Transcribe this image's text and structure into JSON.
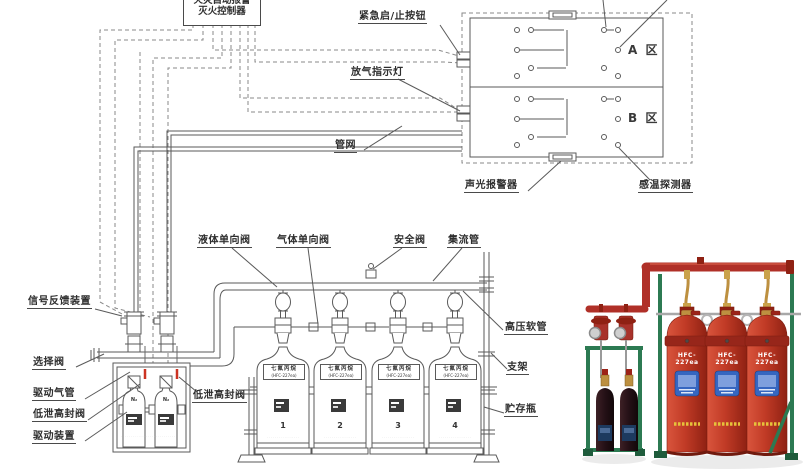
{
  "controller": {
    "line1": "火灾自动报警",
    "line2": "灭火控制器"
  },
  "zones": {
    "a": "A 区",
    "b": "B 区"
  },
  "labels": {
    "emergency_button": "紧急启/止按钮",
    "release_indicator": "放气指示灯",
    "pipe_network": "管网",
    "sound_light_alarm": "声光报警器",
    "heat_detector": "感温探测器",
    "liquid_check_valve": "液体单向阀",
    "gas_check_valve": "气体单向阀",
    "safety_valve": "安全阀",
    "manifold": "集流管",
    "signal_feedback": "信号反馈装置",
    "selector_valve": "选择阀",
    "drive_gas_pipe": "驱动气管",
    "low_leak_valve_left": "低泄高封阀",
    "drive_device": "驱动装置",
    "low_leak_valve_right": "低泄高封阀",
    "hp_hose": "高压软管",
    "bracket": "支架",
    "storage_bottle": "贮存瓶"
  },
  "cylinders": {
    "plate_line1": "七氟丙烷",
    "plate_line2": "(HFC-227ea)",
    "numbers": [
      "1",
      "2",
      "3",
      "4"
    ],
    "fine_print": "·······················"
  },
  "drive_bottles": {
    "gas_label": "N₂",
    "box_fine_print": "····························"
  },
  "photo": {
    "cylinder_text": "HFC-227ea"
  },
  "colors": {
    "line": "#5a5a5a",
    "wire": "#8a8a8a",
    "label_text": "#2e2e2e",
    "highlight_red": "#cc3322",
    "photo_red": "#c13b2a",
    "photo_dark_red": "#8f2113",
    "photo_green": "#2c7a52",
    "photo_blue": "#3566c0",
    "brass": "#bd9040"
  }
}
